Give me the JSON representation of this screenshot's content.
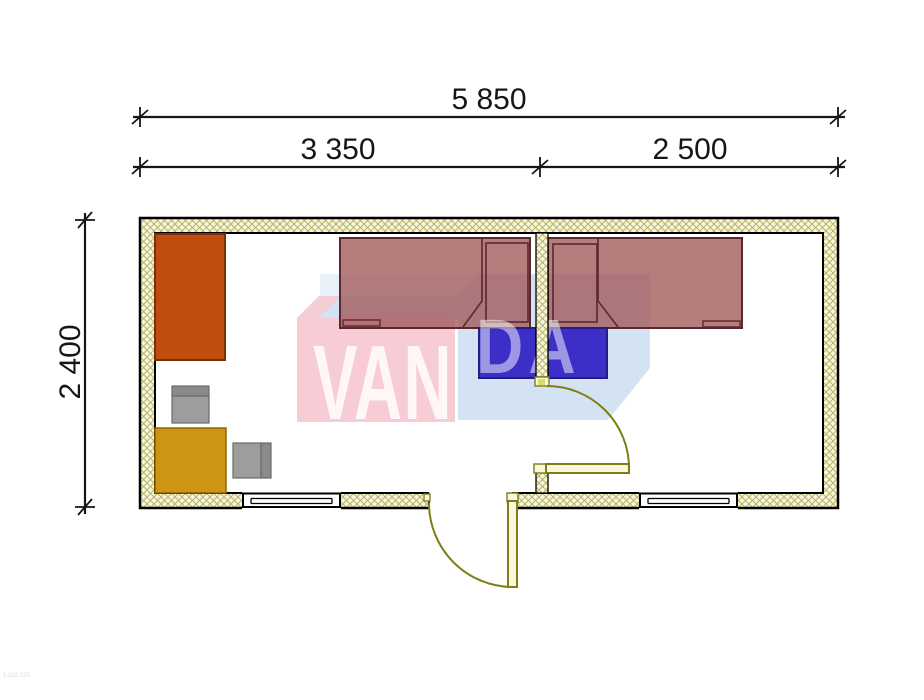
{
  "dimensions": {
    "overall_width": "5 850",
    "room_left_width": "3 350",
    "room_right_width": "2 500",
    "overall_depth": "2 400"
  },
  "watermark": {
    "text_left": "VAN",
    "text_right": "DA"
  },
  "drawing_code": "1.102.123",
  "colors": {
    "wall_hatch_bg": "#F8F5E1",
    "wall_hatch_line": "#B5B561",
    "wall_outline": "#000000",
    "wardrobe": "#BE4D0F",
    "wardrobe_border": "#7A2F07",
    "table": "#CE9414",
    "table_border": "#8B6508",
    "chair_seat": "#9D9D9D",
    "chair_back": "#8A8A8A",
    "chair_border": "#6A6A6A",
    "bed_fill": "rgba(162,88,88,0.78)",
    "bed_border": "#5C2731",
    "nightstand": "#3B2FC8",
    "nightstand_border": "#241C86",
    "door": "#7E7E14",
    "door_leaf_fill": "#F8F6E0",
    "door_hinge_dot": "#DADA6E",
    "watermark_pink": "rgba(247,200,208,0.92)",
    "watermark_pink_light": "rgba(247,203,211,0.9)",
    "watermark_blue": "rgba(200,220,240,0.8)",
    "watermark_blue_light": "rgba(214,230,245,0.55)",
    "watermark_text_strong": "rgba(255,255,255,0.82)",
    "watermark_text_soft": "rgba(255,255,255,0.5)",
    "dimension_ink": "#161616",
    "code_text": "#D9D9D9"
  }
}
